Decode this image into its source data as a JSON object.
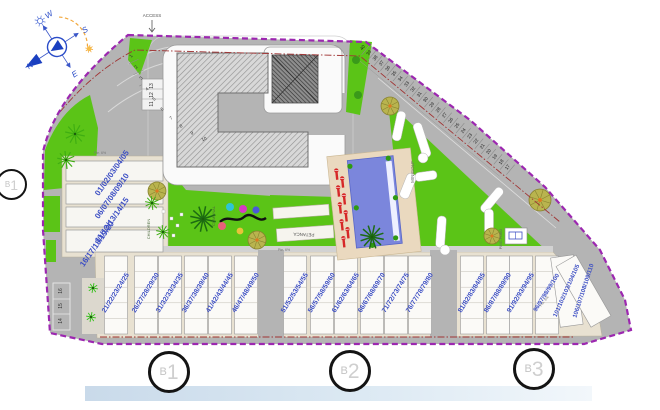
{
  "plan": {
    "access_label": "ACCESS",
    "slope_label": "Pte. 6%",
    "areas": {
      "comunal": "COMUNAL",
      "children": "CHILDREN",
      "minigolf": "MINIGOLF",
      "petanca": "PETANCA",
      "pingpong": "PING-PONG"
    },
    "compass": {
      "n": "N",
      "s": "S",
      "e": "E",
      "w": "W"
    }
  },
  "markers": {
    "left": {
      "prefix": "B",
      "num": "1"
    },
    "bottom": [
      {
        "prefix": "B",
        "num": "1"
      },
      {
        "prefix": "B",
        "num": "2"
      },
      {
        "prefix": "B",
        "num": "3"
      }
    ]
  },
  "parking": {
    "curve": [
      "1",
      "2",
      "3",
      "4",
      "5",
      "6",
      "7",
      "8",
      "9",
      "10"
    ],
    "box": [
      "13",
      "12",
      "11"
    ],
    "left_column": [
      "16",
      "15",
      "14"
    ],
    "diagonal": [
      "40",
      "39",
      "38",
      "37",
      "36",
      "35",
      "34",
      "33",
      "32",
      "31",
      "30",
      "29",
      "28",
      "27",
      "26",
      "25",
      "24",
      "23",
      "22",
      "21",
      "20",
      "19",
      "18",
      "17"
    ]
  },
  "garages": {
    "left_block": [
      "01/02/03/04/05",
      "06/07/08/09/10",
      "11/12/13/14/15",
      "16/17/18/19/20"
    ],
    "strip": [
      "21/22/23/24/25",
      "26/27/28/29/30",
      "31/32/33/34/35",
      "36/37/38/39/40",
      "41/42/43/44/45",
      "46/47/48/49/50",
      "51/52/53/54/55",
      "56/57/58/59/60",
      "61/62/63/64/65",
      "66/67/68/69/70",
      "71/72/73/74/75",
      "76/77/78/79/80",
      "81/82/83/84/85",
      "86/87/88/89/90",
      "91/92/93/94/95",
      "96/97/98/99/100",
      "101/102/103/104/105",
      "106/107/108/109/110"
    ]
  },
  "colors": {
    "boundary_purple": "#9c27b0",
    "setback_red": "#a03434",
    "green": "#5bc417",
    "pool_blue": "#7b86dc",
    "deck_tan": "#ead9bf",
    "garage_number_blue": "#3d4fc4",
    "lounger_red": "#d62828",
    "road_gray": "#b4b4b4",
    "small_number_dark": "#222222"
  }
}
